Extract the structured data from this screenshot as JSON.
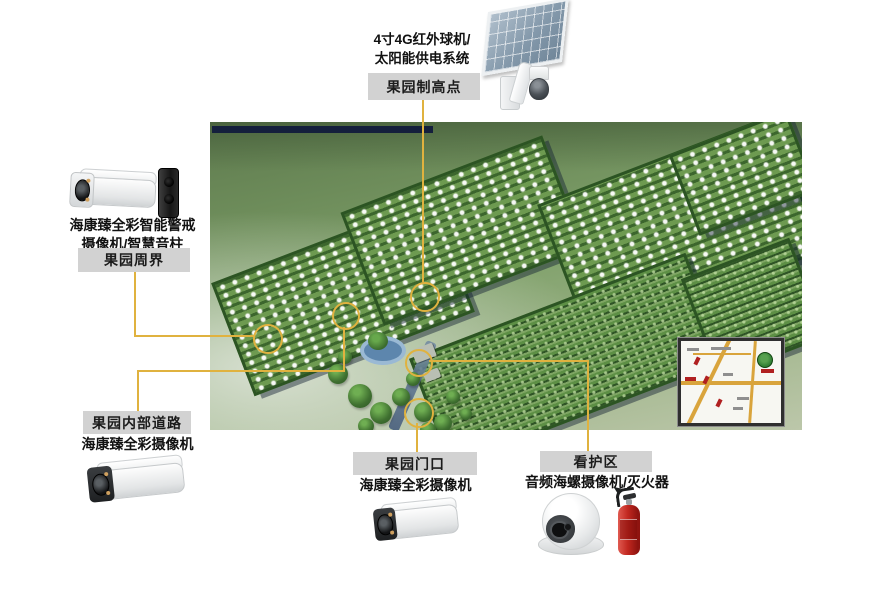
{
  "diagram": {
    "background_color": "#ffffff",
    "accent_color": "#e0b23f",
    "label_box_color": "#d2d2d2"
  },
  "callouts": {
    "highpoint": {
      "device_line1": "4寸4G红外球机/",
      "device_line2": "太阳能供电系统",
      "zone": "果园制高点",
      "icon": "solar-panel-ptz-camera-icon"
    },
    "perimeter": {
      "device_line1": "海康臻全彩智能警戒",
      "device_line2": "摄像机/智慧音柱",
      "zone": "果园周界",
      "icon": "bullet-camera-and-speaker-column-icon"
    },
    "inner_road": {
      "zone": "果园内部道路",
      "device": "海康臻全彩摄像机",
      "icon": "bullet-camera-icon"
    },
    "gate": {
      "zone": "果园门口",
      "device": "海康臻全彩摄像机",
      "icon": "bullet-camera-icon"
    },
    "care_area": {
      "zone": "看护区",
      "device": "音频海螺摄像机/灭火器",
      "icon": "turret-camera-and-fire-extinguisher-icon"
    }
  }
}
